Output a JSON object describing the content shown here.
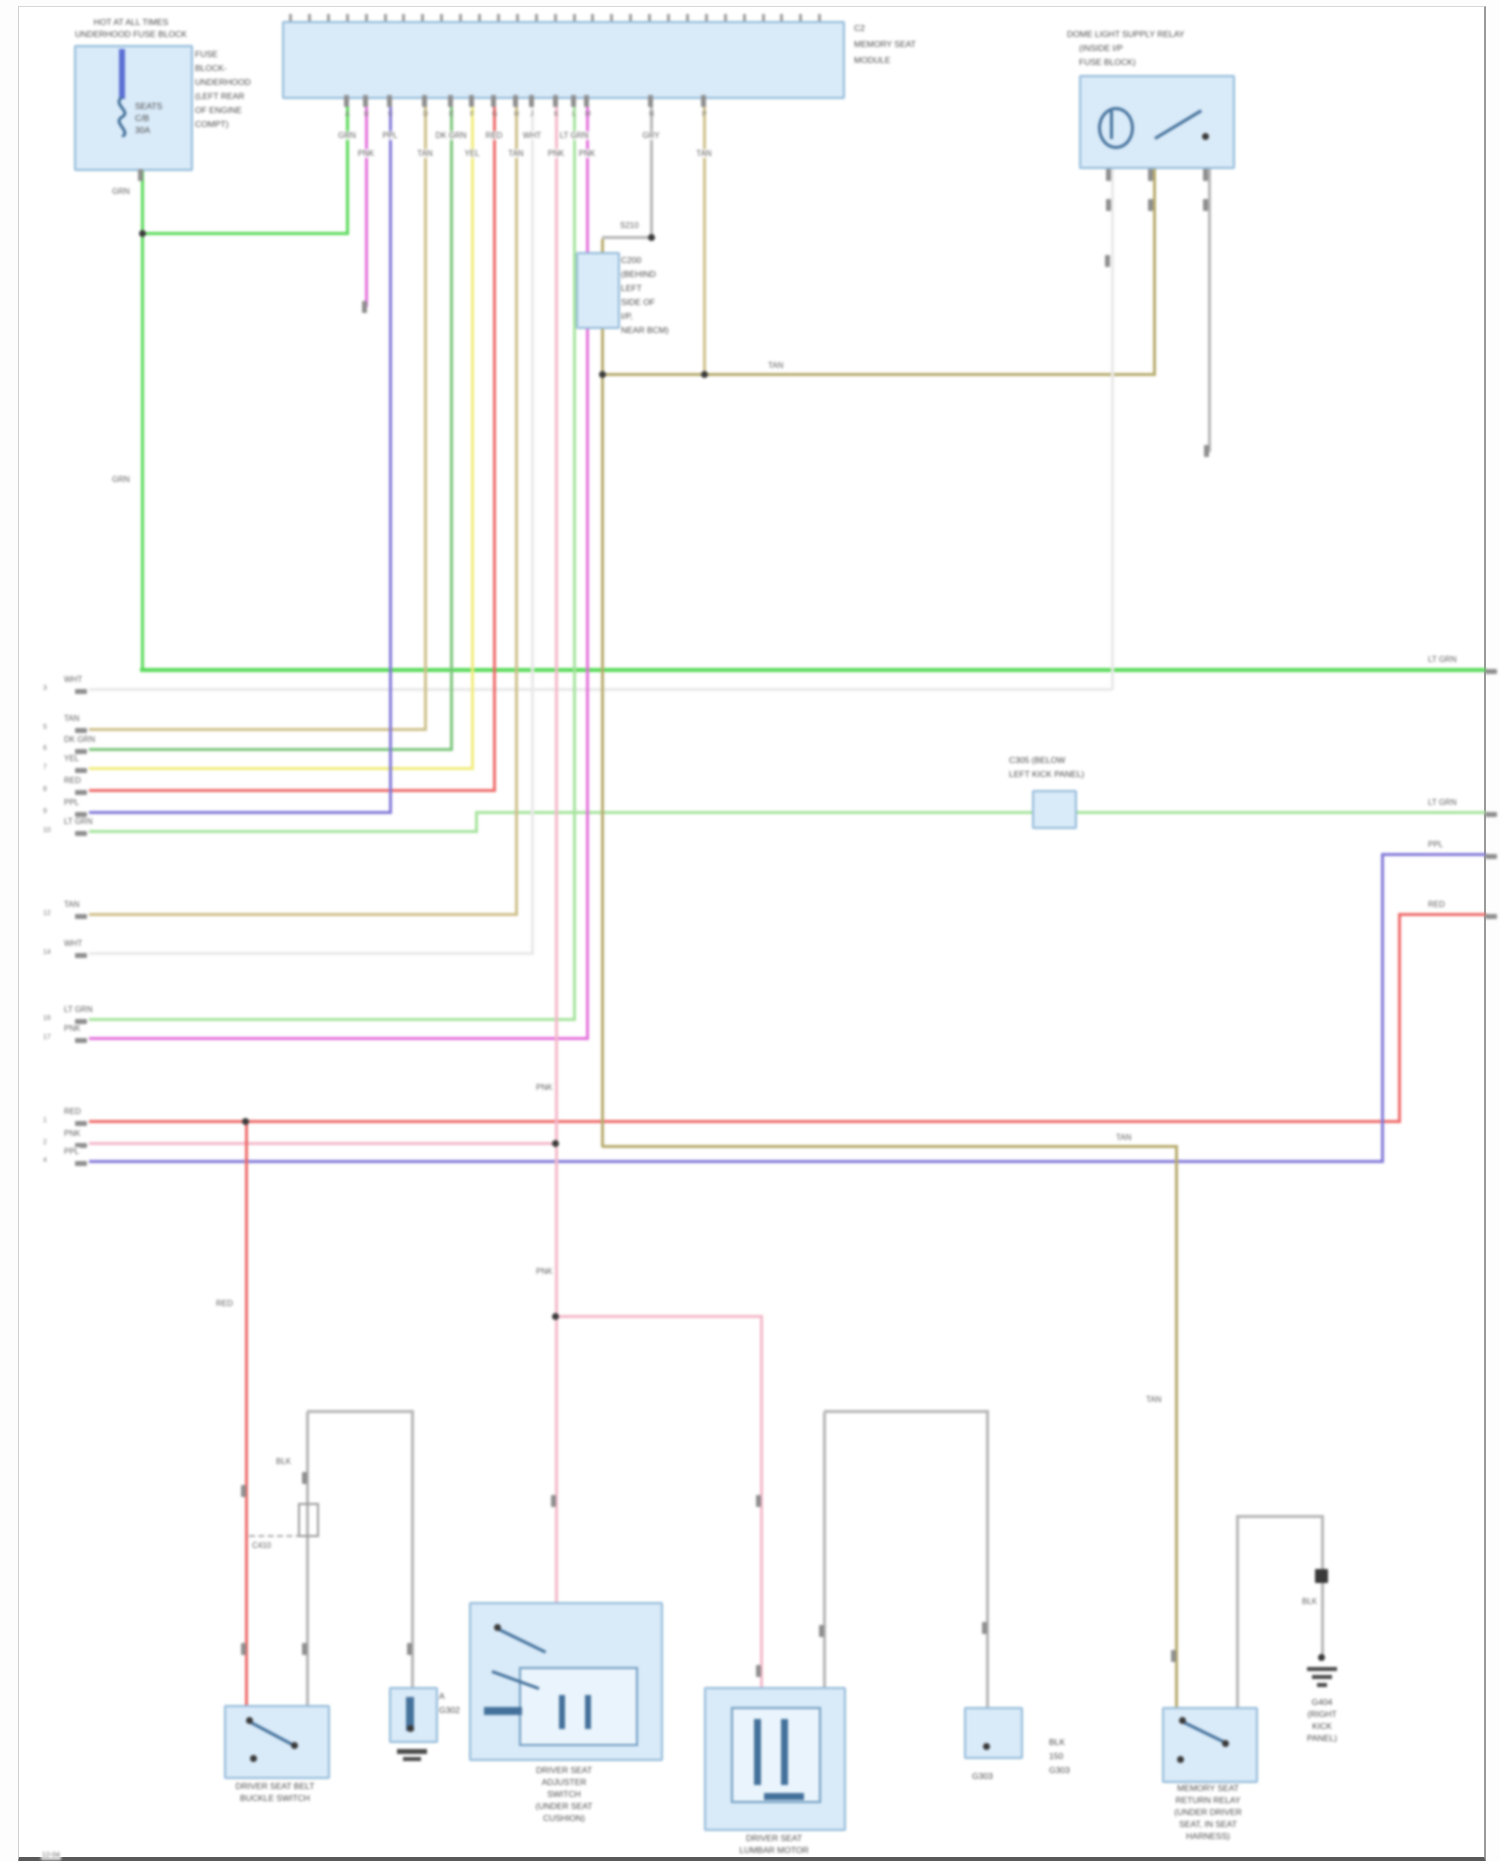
{
  "colors": {
    "component_fill": "#d9eaf8",
    "component_border": "#93bad9",
    "green": "#58da58",
    "lt_green": "#a6e39e",
    "dk_green": "#7cc67c",
    "yellow": "#f1ec7c",
    "red": "#ee6a6a",
    "pink": "#f4b9ca",
    "magenta": "#e371dc",
    "purple": "#837ad8",
    "tan": "#cfc08c",
    "khaki": "#b7ab6d",
    "white_wire": "#e9e9e9",
    "grey_wire": "#b5b5b5"
  },
  "battery": {
    "title1": "HOT AT ALL TIMES",
    "title2": "UNDERHOOD FUSE BLOCK",
    "inside": [
      "SEATS",
      "C/B",
      "30A"
    ],
    "side": [
      "FUSE",
      "BLOCK-",
      "UNDERHOOD",
      "(LEFT REAR",
      "OF ENGINE",
      "COMPT)"
    ],
    "wire_label_upper": "GRN",
    "wire_label_lower": "GRN"
  },
  "module": {
    "name1": "C2",
    "name2": "MEMORY SEAT",
    "name3": "MODULE",
    "tick_count": 29,
    "pins": [
      {
        "x": 328,
        "pin": "A",
        "code": "GRN"
      },
      {
        "x": 347,
        "pin": "B",
        "code": "PNK"
      },
      {
        "x": 371,
        "pin": "C",
        "code": "PPL"
      },
      {
        "x": 406,
        "pin": "D",
        "code": "TAN"
      },
      {
        "x": 432,
        "pin": "E",
        "code": "DK GRN"
      },
      {
        "x": 453,
        "pin": "F",
        "code": "YEL"
      },
      {
        "x": 475,
        "pin": "G",
        "code": "RED"
      },
      {
        "x": 497,
        "pin": "H",
        "code": "TAN"
      },
      {
        "x": 513,
        "pin": "J",
        "code": "WHT"
      },
      {
        "x": 537,
        "pin": "K",
        "code": "PNK"
      },
      {
        "x": 555,
        "pin": "L",
        "code": "LT GRN"
      },
      {
        "x": 568,
        "pin": "M",
        "code": "PNK"
      },
      {
        "x": 632,
        "pin": "N",
        "code": "GRY"
      },
      {
        "x": 685,
        "pin": "P",
        "code": "TAN"
      }
    ]
  },
  "relay": {
    "line1": "DOME LIGHT SUPPLY RELAY",
    "line2": "(INSIDE I/P",
    "line3": "FUSE BLOCK)"
  },
  "splice": {
    "label": "S210"
  },
  "c200": {
    "side": [
      "C200",
      "(BEHIND",
      "LEFT",
      "SIDE OF",
      "I/P,",
      "NEAR BCM)"
    ]
  },
  "c305": {
    "line1": "C305 (BELOW",
    "line2": "LEFT KICK PANEL)"
  },
  "inline_c": {
    "label": "C410"
  },
  "left_terminals": [
    {
      "y": 683,
      "num": "3",
      "label": "WHT"
    },
    {
      "y": 722,
      "num": "5",
      "label": "TAN"
    },
    {
      "y": 743,
      "num": "6",
      "label": "DK GRN"
    },
    {
      "y": 762,
      "num": "7",
      "label": "YEL"
    },
    {
      "y": 784,
      "num": "8",
      "label": "RED"
    },
    {
      "y": 806,
      "num": "9",
      "label": "PPL"
    },
    {
      "y": 825,
      "num": "10",
      "label": "LT GRN"
    },
    {
      "y": 908,
      "num": "12",
      "label": "TAN"
    },
    {
      "y": 947,
      "num": "14",
      "label": "WHT"
    },
    {
      "y": 1013,
      "num": "16",
      "label": "LT GRN"
    },
    {
      "y": 1032,
      "num": "17",
      "label": "PNK"
    },
    {
      "y": 1115,
      "num": "1",
      "label": "RED"
    },
    {
      "y": 1137,
      "num": "2",
      "label": "PNK"
    },
    {
      "y": 1155,
      "num": "4",
      "label": "PPL"
    }
  ],
  "right_terminals": [
    {
      "y": 663,
      "pin": "A",
      "label": "LT GRN"
    },
    {
      "y": 806,
      "pin": "B",
      "label": "LT GRN"
    },
    {
      "y": 848,
      "pin": "C",
      "label": "PPL"
    },
    {
      "y": 908,
      "pin": "D",
      "label": "RED"
    }
  ],
  "wire_labels": [
    {
      "x": 92,
      "y": 180,
      "text": "GRN"
    },
    {
      "x": 92,
      "y": 468,
      "text": "GRN"
    },
    {
      "x": 748,
      "y": 354,
      "text": "TAN"
    },
    {
      "x": 1096,
      "y": 1126,
      "text": "TAN"
    },
    {
      "x": 196,
      "y": 1292,
      "text": "RED"
    },
    {
      "x": 256,
      "y": 1450,
      "text": "BLK"
    },
    {
      "x": 516,
      "y": 1076,
      "text": "PNK"
    },
    {
      "x": 516,
      "y": 1260,
      "text": "PNK"
    },
    {
      "x": 1282,
      "y": 1590,
      "text": "BLK"
    },
    {
      "x": 1126,
      "y": 1388,
      "text": "TAN"
    }
  ],
  "components": {
    "a": {
      "line1": "DRIVER SEAT BELT",
      "line2": "BUCKLE SWITCH"
    },
    "b": {
      "side1": "A",
      "side2": "G302"
    },
    "c": {
      "lines": [
        "DRIVER SEAT",
        "ADJUSTER",
        "SWITCH",
        "(UNDER SEAT",
        "CUSHION)"
      ]
    },
    "d": {
      "line1": "DRIVER SEAT",
      "line2": "LUMBAR MOTOR"
    },
    "e": {
      "below": "G303",
      "side": [
        "BLK",
        "150",
        "G303"
      ]
    },
    "f": {
      "lines": [
        "MEMORY SEAT",
        "RETURN RELAY",
        "(UNDER DRIVER",
        "SEAT, IN SEAT",
        "HARNESS)"
      ]
    },
    "g404": {
      "lines": [
        "G404",
        "(RIGHT",
        "KICK",
        "PANEL)"
      ]
    }
  },
  "footer": "12-04"
}
